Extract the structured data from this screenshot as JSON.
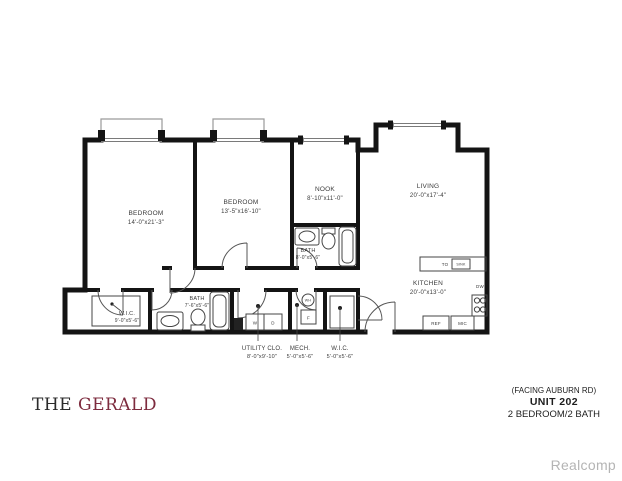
{
  "branding": {
    "the": "THE",
    "name": "GERALD",
    "name_color": "#7d2b3e"
  },
  "unit_info": {
    "facing": "(FACING AUBURN RD)",
    "unit": "UNIT 202",
    "config": "2 BEDROOM/2 BATH"
  },
  "watermark": "Realcomp",
  "rooms": {
    "bedroom1": {
      "name": "BEDROOM",
      "dims": "14'-0\"x21'-3\""
    },
    "bedroom2": {
      "name": "BEDROOM",
      "dims": "13'-5\"x16'-10\""
    },
    "nook": {
      "name": "NOOK",
      "dims": "8'-10\"x11'-0\""
    },
    "living": {
      "name": "LIVING",
      "dims": "20'-0\"x17'-4\""
    },
    "bath1": {
      "name": "BATH",
      "dims": "8'-0\"x5'-6\""
    },
    "kitchen": {
      "name": "KITCHEN",
      "dims": "20'-0\"x13'-0\""
    },
    "wic1": {
      "name": "W.I.C.",
      "dims": "9'-0\"x5'-6\""
    },
    "bath2": {
      "name": "BATH",
      "dims": "7'-6\"x5'-6\""
    },
    "utility": {
      "name": "UTILITY CLO.",
      "dims": "8'-0\"x9'-10\""
    },
    "mech": {
      "name": "MECH.",
      "dims": "5'-0\"x5'-6\""
    },
    "wic2": {
      "name": "W.I.C.",
      "dims": "5'-0\"x5'-6\""
    }
  },
  "appliances": {
    "to": "TO",
    "sink": "SINK",
    "dw": "DW",
    "ref": "REF",
    "mic": "MIC",
    "washer": "W",
    "dryer": "D",
    "water_heater": "WH",
    "furnace": "F"
  }
}
